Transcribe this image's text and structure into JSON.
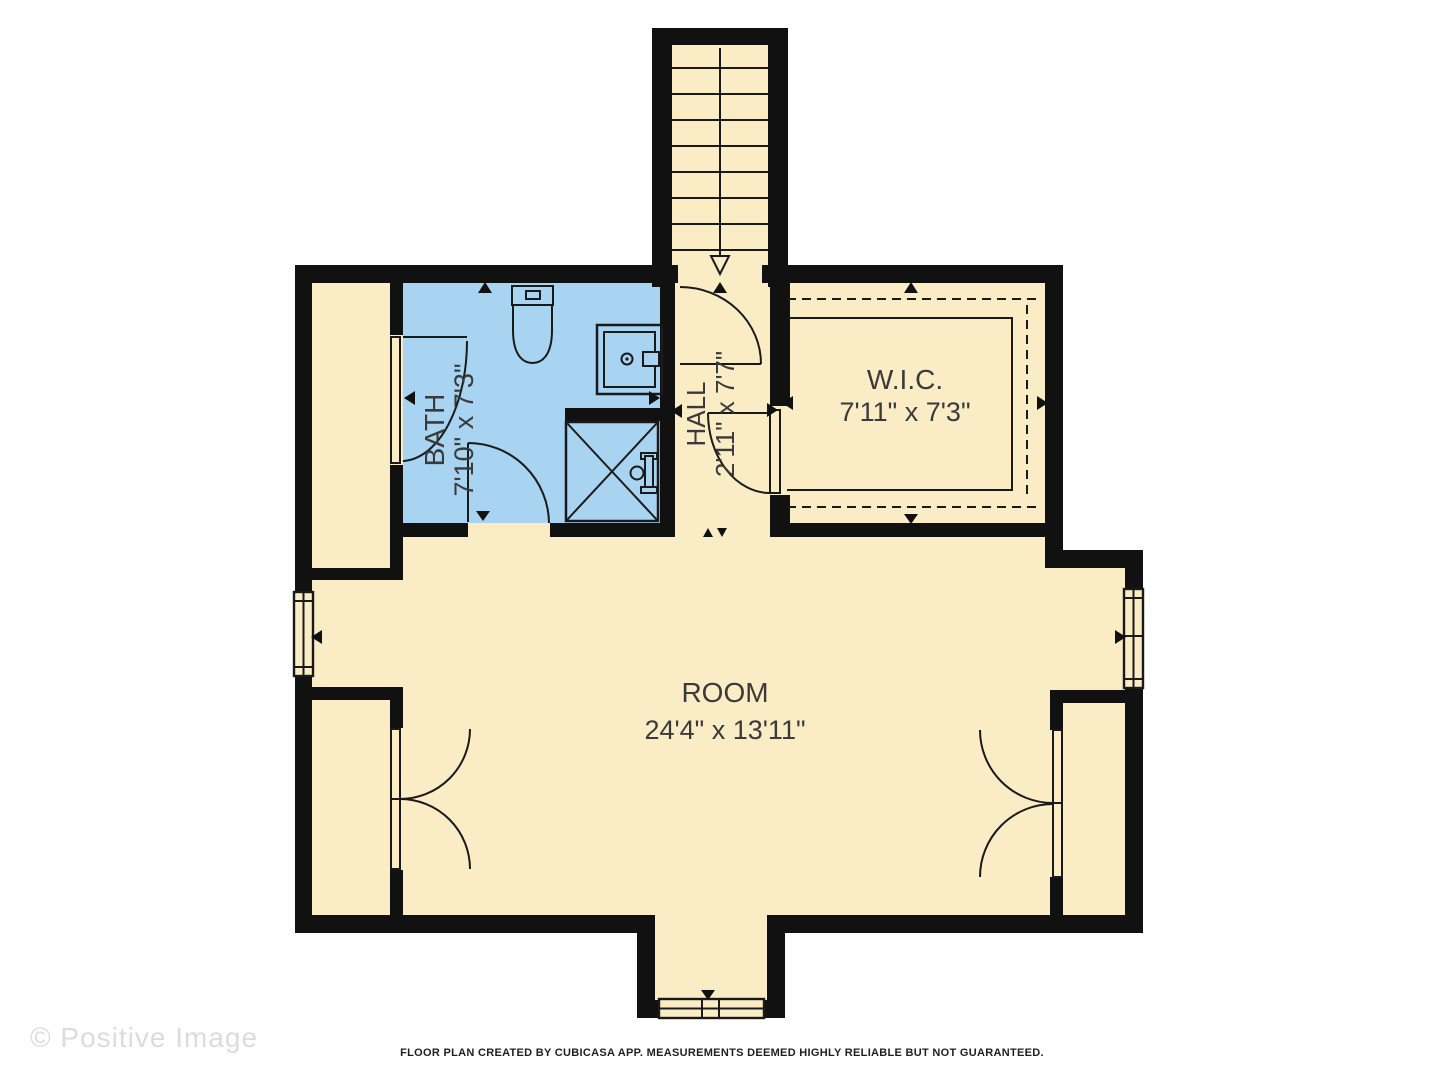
{
  "plan": {
    "type": "floor-plan",
    "rooms": [
      {
        "name": "BATH",
        "dims": "7'10\" x 7'3\"",
        "floor_color": "#A8D4F2",
        "label_rotated": true
      },
      {
        "name": "HALL",
        "dims": "2'11\" x 7'7\"",
        "floor_color": "#FAECC5",
        "label_rotated": true
      },
      {
        "name": "W.I.C.",
        "dims": "7'11\" x 7'3\"",
        "floor_color": "#FAECC5",
        "label_rotated": false
      },
      {
        "name": "ROOM",
        "dims": "24'4\" x 13'11\"",
        "floor_color": "#FAECC5",
        "label_rotated": false
      }
    ],
    "features": [
      "staircase-down",
      "shower",
      "toilet",
      "sink",
      "closet-shelving",
      "double-closet-doors",
      "windows"
    ],
    "colors": {
      "wall": "#111111",
      "floor": "#FAECC5",
      "bath": "#A8D4F2",
      "text": "#3a3a3a",
      "background": "#ffffff"
    }
  },
  "watermark": {
    "text": "© Positive Image"
  },
  "footer": {
    "text": "FLOOR PLAN CREATED BY CUBICASA APP. MEASUREMENTS DEEMED HIGHLY RELIABLE BUT NOT GUARANTEED."
  }
}
